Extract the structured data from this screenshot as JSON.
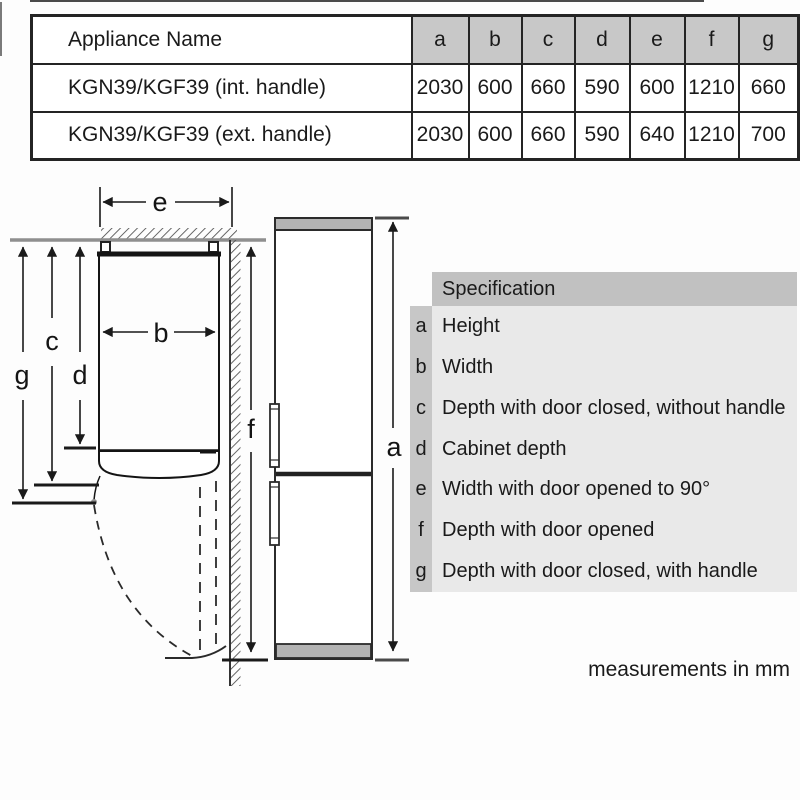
{
  "table": {
    "header": [
      "Appliance Name",
      "a",
      "b",
      "c",
      "d",
      "e",
      "f",
      "g"
    ],
    "rows": [
      {
        "name": "KGN39/KGF39 (int. handle)",
        "values": [
          "2030",
          "600",
          "660",
          "590",
          "600",
          "1210",
          "660"
        ]
      },
      {
        "name": "KGN39/KGF39 (ext. handle)",
        "values": [
          "2030",
          "600",
          "660",
          "590",
          "640",
          "1210",
          "700"
        ]
      }
    ]
  },
  "legend": {
    "header": "Specification",
    "items": [
      {
        "key": "a",
        "label": "Height"
      },
      {
        "key": "b",
        "label": "Width"
      },
      {
        "key": "c",
        "label": "Depth with door closed, without handle"
      },
      {
        "key": "d",
        "label": "Cabinet depth"
      },
      {
        "key": "e",
        "label": "Width with door opened to 90°"
      },
      {
        "key": "f",
        "label": "Depth with door opened"
      },
      {
        "key": "g",
        "label": "Depth with door closed, with handle"
      }
    ]
  },
  "diagram": {
    "labels": {
      "a": "a",
      "b": "b",
      "c": "c",
      "d": "d",
      "e": "e",
      "f": "f",
      "g": "g"
    }
  },
  "footer": {
    "note": "measurements in mm"
  },
  "colors": {
    "table_header_bg": "#c8c8c8",
    "legend_header_bg": "#c1c1c1",
    "legend_key_bg": "#c7c7c7",
    "legend_body_bg": "#e9e9e9",
    "fridge_cap_gray": "#b3b3b3",
    "wall_gray": "#8f8f8f",
    "line_black": "#242424"
  }
}
